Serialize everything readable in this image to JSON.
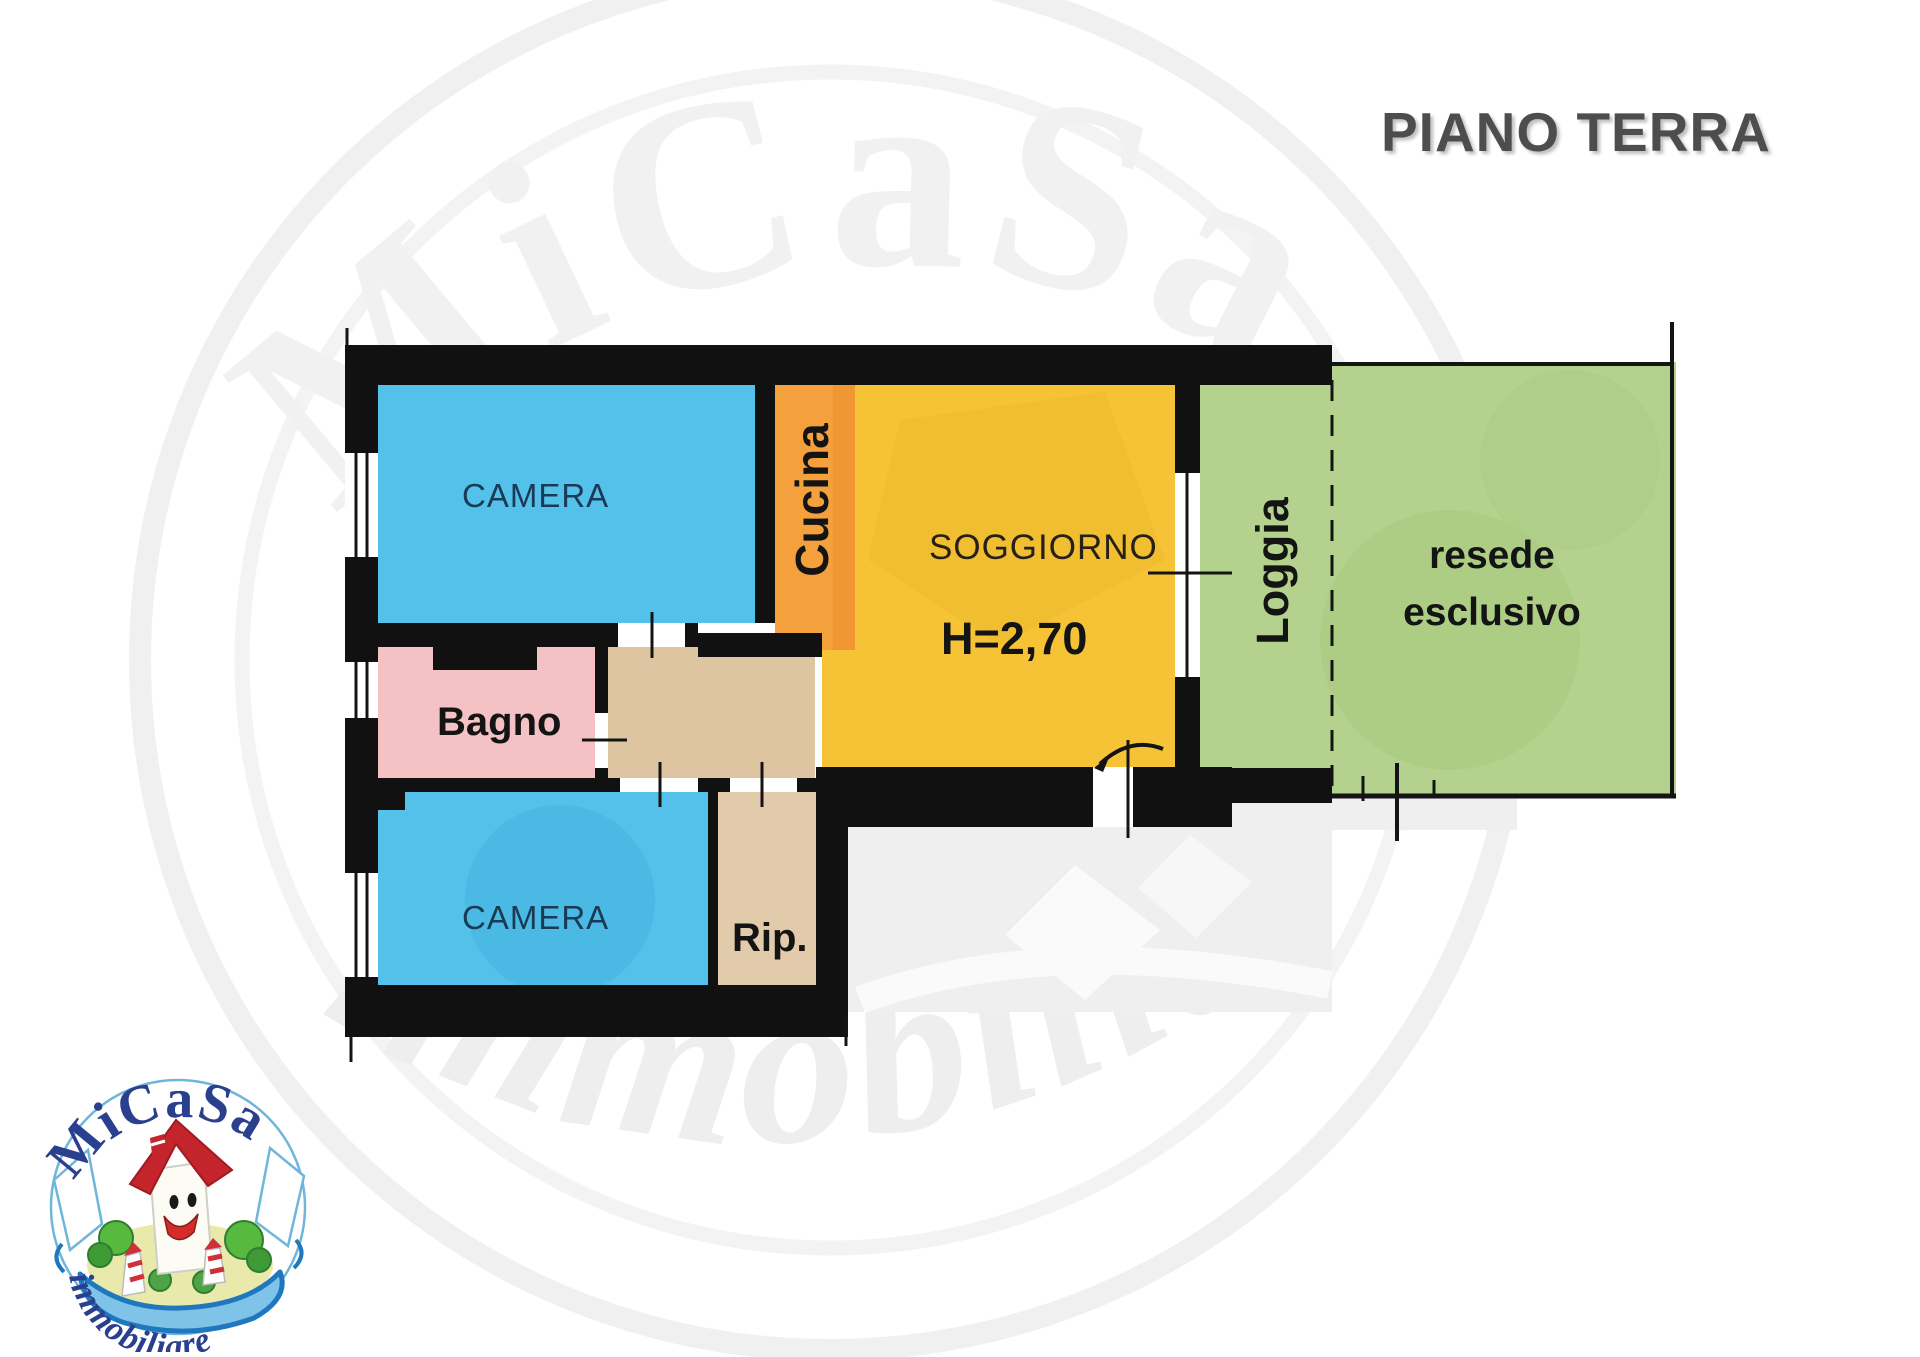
{
  "header": {
    "title": "PIANO TERRA"
  },
  "rooms": {
    "camera_top": "CAMERA",
    "cucina": "Cucina",
    "soggiorno": "SOGGIORNO",
    "sogg_h": "H=2,70",
    "bagno": "Bagno",
    "camera_bottom": "CAMERA",
    "rip": "Rip.",
    "loggia": "Loggia",
    "resede1": "resede",
    "resede2": "esclusivo"
  },
  "watermark": {
    "brand": "MiCaSa",
    "word": "immobiliare"
  },
  "logo": {
    "brand": "MiCaSa",
    "word": "immobiliare"
  },
  "colors": {
    "wall": "#111111",
    "camera": "#54c1ea",
    "cucina": "#f4a03c",
    "cucina_dark": "#ee9430",
    "soggiorno": "#f5c335",
    "bagno": "#f4c2c5",
    "corridoio": "#ddc5a2",
    "rip": "#e2cbab",
    "verde": "#b4d28d",
    "esterno": "#efefef",
    "titolo": "#4d4d4d",
    "logo_blu": "#2b3f8f",
    "label_navy": "#1a3a55"
  }
}
